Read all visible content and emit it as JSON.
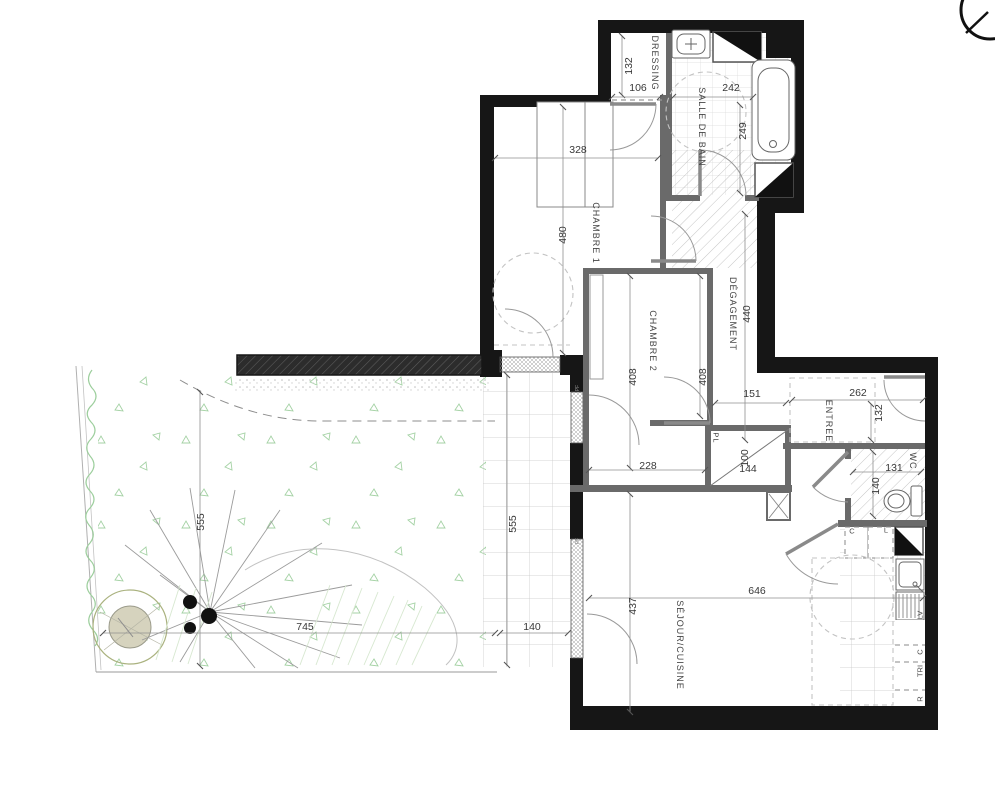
{
  "rooms": {
    "dressing": "DRESSING",
    "bathroom": "SALLE DE BAIN",
    "bedroom1": "CHAMBRE 1",
    "bedroom2": "CHAMBRE 2",
    "hallway": "DÉGAGEMENT",
    "entry": "ENTREE",
    "wc": "WC",
    "living_kitchen": "SÉJOUR/CUISINE"
  },
  "dimensions": {
    "dressing_depth": "132",
    "dressing_opening": "106",
    "bathroom_width": "242",
    "bathroom_depth": "249",
    "bedroom1_width": "328",
    "bedroom1_depth": "480",
    "hallway_length": "440",
    "bedroom2_left": "408",
    "bedroom2_right": "408",
    "bedroom2_width": "228",
    "hall_junction": "151",
    "entry_width": "262",
    "entry_depth": "132",
    "closet_depth": "100",
    "closet_width": "144",
    "wc_width": "131",
    "wc_depth": "140",
    "living_width": "646",
    "living_depth": "437",
    "garden_depth": "555",
    "garden_width": "745",
    "terrace_length": "555",
    "terrace_width": "140"
  },
  "annotations": {
    "closet": "PL",
    "slot_c": "C",
    "slot_l": "L",
    "dishwasher": "LV",
    "appliance_c": "C",
    "sorting": "TRI",
    "fridge": "R",
    "window_tag_1": "PF",
    "window_tag_2": "PF"
  },
  "colors": {
    "wall": "#161616",
    "partition": "#6a6a6a",
    "dimension_text": "#383838",
    "garden_green": "#a5d2a5"
  }
}
